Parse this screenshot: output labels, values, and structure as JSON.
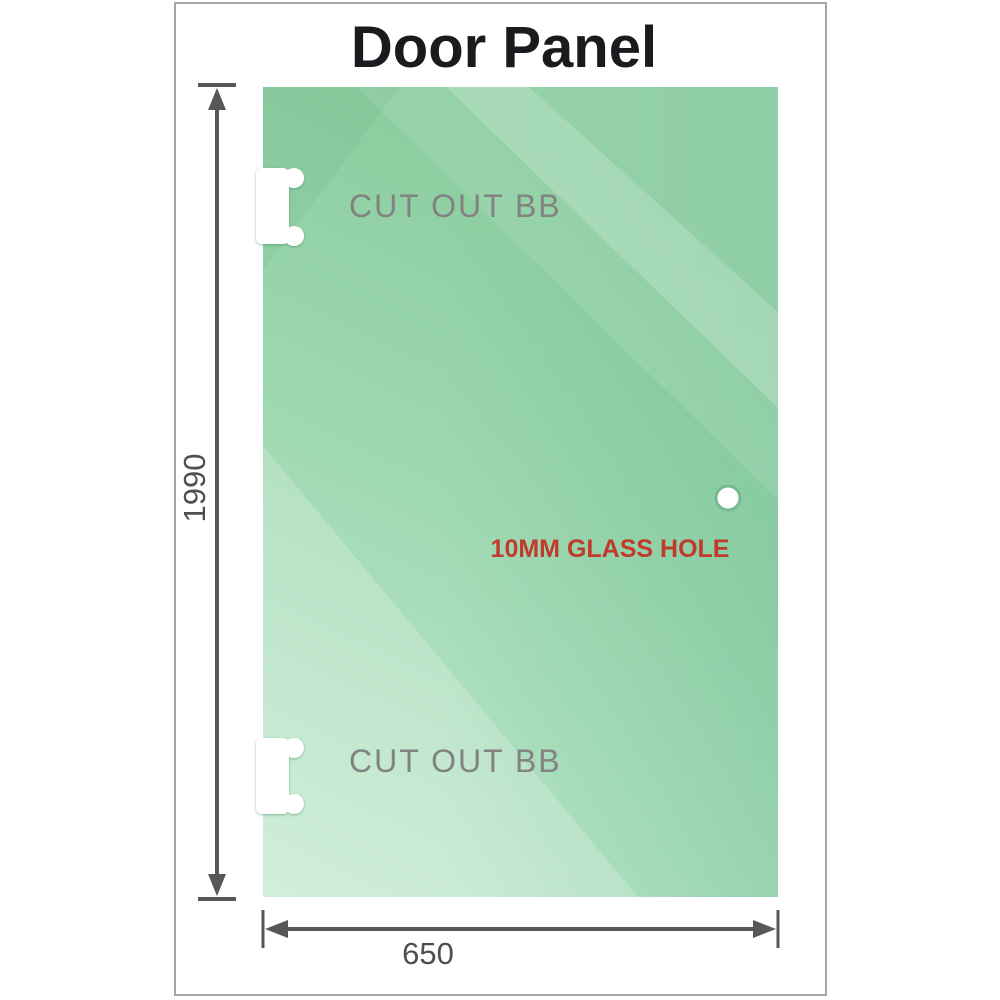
{
  "title": "Door Panel",
  "panel": {
    "cutouts": [
      {
        "label": "CUT OUT BB"
      },
      {
        "label": "CUT OUT BB"
      }
    ],
    "hole_label": "10MM GLASS HOLE"
  },
  "dims": {
    "height": "1990",
    "width": "650"
  },
  "colors": {
    "glass_green_dark": "#8acd9e",
    "glass_green_mid": "#9fd8b1",
    "glass_green_light": "#c6ebd3",
    "dimension_gray": "#575757",
    "cutout_label_gray": "#828282",
    "hole_label_red": "#c13b2d",
    "frame_border_gray": "#a5a5a5",
    "title_black": "#1b1b1f"
  }
}
